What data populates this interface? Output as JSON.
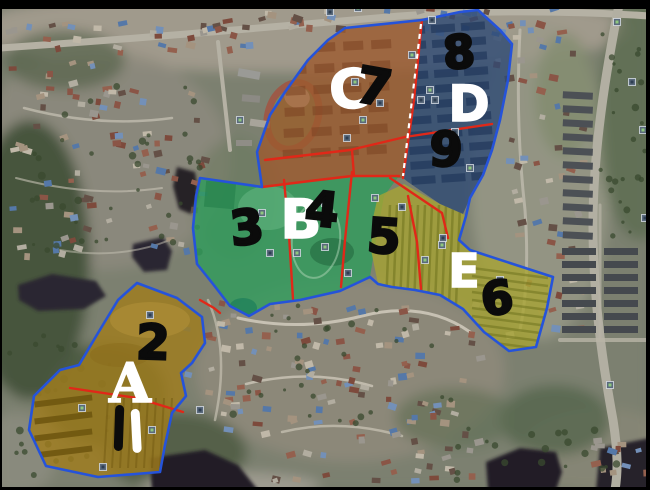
{
  "map": {
    "title": "Satellite map with zoned planning overlays",
    "view": "aerial-satellite",
    "colors": {
      "region_A_fill": "#a07d1d",
      "region_B_fill": "#2e9e5c",
      "region_C_fill": "#9c5a2e",
      "region_D_fill": "#2e4a74",
      "region_E_fill": "#a8a432",
      "outline_blue": "#2553da",
      "divider_red": "#e02818",
      "boundary_dash_white": "#ffffff",
      "label_white": "#ffffff",
      "label_black": "#0b0b0b",
      "frame_black": "#000000"
    },
    "zones": [
      {
        "zone": "A",
        "subzones": [
          "1",
          "2"
        ]
      },
      {
        "zone": "B",
        "subzones": [
          "3",
          "4"
        ]
      },
      {
        "zone": "C",
        "subzones": [
          "7"
        ]
      },
      {
        "zone": "D",
        "subzones": [
          "8",
          "9"
        ]
      },
      {
        "zone": "E",
        "subzones": [
          "5",
          "6"
        ]
      }
    ],
    "regions": [
      {
        "id": "C",
        "fill": "#9c5a2e",
        "opacity": 0.8,
        "points": "345,28 422,20 403,178 352,176 310,181 262,187 257,152 270,115 285,92 308,60 328,40"
      },
      {
        "id": "D",
        "fill": "#2e4a74",
        "opacity": 0.8,
        "points": "422,20 460,12 478,10 500,30 512,44 508,80 500,120 492,150 483,175 470,198 463,214 440,204 408,182 403,178"
      },
      {
        "id": "B",
        "fill": "#2e9e5c",
        "opacity": 0.78,
        "points": "200,178 262,187 310,181 352,176 399,176 384,196 376,240 370,277 340,291 300,300 270,304 249,316 230,306 213,284 197,264 193,228 196,196"
      },
      {
        "id": "E",
        "fill": "#a8a432",
        "opacity": 0.78,
        "points": "378,196 404,184 440,204 463,214 466,216 459,240 470,250 553,277 547,308 536,347 509,351 484,332 463,309 440,295 415,290 392,287 378,284 371,250 373,218"
      },
      {
        "id": "A",
        "fill": "#a07d1d",
        "opacity": 0.82,
        "points": "137,283 177,298 202,317 205,343 192,363 181,373 186,396 172,413 165,445 160,472 98,477 46,466 29,430 34,396 60,370 79,365 98,333 118,300"
      }
    ],
    "dividers_red": [
      {
        "points": "265,160 350,150 405,137 492,124"
      },
      {
        "points": "262,187 310,181 352,176 399,176"
      },
      {
        "points": "352,150 354,176"
      },
      {
        "points": "422,20 414,100 403,178"
      },
      {
        "points": "390,178 442,213 448,238"
      },
      {
        "points": "352,172 345,240 341,287"
      },
      {
        "points": "284,180 289,235 293,299"
      },
      {
        "points": "408,196 417,242 421,289"
      },
      {
        "points": "70,388 137,398 183,412"
      },
      {
        "points": "200,300 214,308 220,313"
      }
    ],
    "boundary_dashes_white": [
      {
        "points": "421,24 412,100 403,176"
      }
    ],
    "outlines_blue": [
      {
        "id": "main-complex",
        "points": "345,28 422,20 460,12 478,10 500,30 512,44 508,80 500,120 492,150 483,175 470,198 466,216 459,240 470,250 553,277 547,308 536,347 509,351 484,332 463,309 440,295 415,290 392,287 378,284 370,277 340,291 300,300 270,304 249,316 230,306 213,284 197,264 193,228 196,196 200,178 262,187 257,152 270,115 285,92 308,60 328,40"
      },
      {
        "id": "zone-A",
        "points": "137,283 177,298 202,317 205,343 192,363 181,373 186,396 172,413 165,445 160,472 98,477 46,466 29,430 34,396 60,370 79,365 98,333 118,300"
      }
    ],
    "labels": [
      {
        "id": "zone-letter-C",
        "text": "C",
        "kind": "letter",
        "color": "#ffffff",
        "x": 349,
        "y": 90,
        "size": 54,
        "rot": -4
      },
      {
        "id": "subzone-number-7",
        "text": "7",
        "kind": "number",
        "color": "#0b0b0b",
        "x": 374,
        "y": 87,
        "size": 50,
        "rot": 10
      },
      {
        "id": "subzone-number-8",
        "text": "8",
        "kind": "number",
        "color": "#0b0b0b",
        "x": 459,
        "y": 52,
        "size": 46,
        "rot": -4
      },
      {
        "id": "zone-letter-D",
        "text": "D",
        "kind": "letter",
        "color": "#ffffff",
        "x": 469,
        "y": 104,
        "size": 50,
        "rot": 0
      },
      {
        "id": "subzone-number-9",
        "text": "9",
        "kind": "number",
        "color": "#0b0b0b",
        "x": 446,
        "y": 150,
        "size": 48,
        "rot": 3
      },
      {
        "id": "subzone-number-3",
        "text": "3",
        "kind": "number",
        "color": "#0b0b0b",
        "x": 247,
        "y": 228,
        "size": 48,
        "rot": -6
      },
      {
        "id": "zone-letter-B",
        "text": "B",
        "kind": "letter",
        "color": "#ffffff",
        "x": 301,
        "y": 220,
        "size": 54,
        "rot": 0
      },
      {
        "id": "subzone-number-4",
        "text": "4",
        "kind": "number",
        "color": "#0b0b0b",
        "x": 322,
        "y": 210,
        "size": 48,
        "rot": 6
      },
      {
        "id": "subzone-number-5",
        "text": "5",
        "kind": "number",
        "color": "#0b0b0b",
        "x": 384,
        "y": 237,
        "size": 48,
        "rot": 4
      },
      {
        "id": "zone-letter-E",
        "text": "E",
        "kind": "letter",
        "color": "#ffffff",
        "x": 464,
        "y": 271,
        "size": 46,
        "rot": 0
      },
      {
        "id": "subzone-number-6",
        "text": "6",
        "kind": "number",
        "color": "#0b0b0b",
        "x": 497,
        "y": 298,
        "size": 46,
        "rot": -8
      },
      {
        "id": "subzone-number-2",
        "text": "2",
        "kind": "number",
        "color": "#0b0b0b",
        "x": 153,
        "y": 343,
        "size": 48,
        "rot": 2
      },
      {
        "id": "zone-letter-A",
        "text": "A",
        "kind": "letter",
        "serif": true,
        "color": "#ffffff",
        "x": 130,
        "y": 383,
        "size": 54,
        "rot": 0
      },
      {
        "id": "subzone-number-1",
        "text": "1",
        "kind": "number",
        "style": "bar",
        "color": "#0b0b0b",
        "x": 119,
        "y": 428,
        "size": 50,
        "rot": 2
      },
      {
        "id": "subzone-number-1-white-mark",
        "text": "1",
        "kind": "number",
        "style": "bar",
        "color": "#ffffff",
        "x": 136,
        "y": 431,
        "size": 48,
        "rot": -3
      }
    ],
    "photo_markers": [
      {
        "x": 330,
        "y": 12
      },
      {
        "x": 358,
        "y": 8
      },
      {
        "x": 432,
        "y": 20
      },
      {
        "x": 617,
        "y": 22
      },
      {
        "x": 632,
        "y": 82
      },
      {
        "x": 643,
        "y": 130
      },
      {
        "x": 645,
        "y": 218
      },
      {
        "x": 355,
        "y": 82
      },
      {
        "x": 380,
        "y": 103
      },
      {
        "x": 363,
        "y": 120
      },
      {
        "x": 347,
        "y": 138
      },
      {
        "x": 412,
        "y": 55
      },
      {
        "x": 435,
        "y": 100
      },
      {
        "x": 430,
        "y": 90
      },
      {
        "x": 455,
        "y": 132
      },
      {
        "x": 470,
        "y": 168
      },
      {
        "x": 421,
        "y": 100
      },
      {
        "x": 262,
        "y": 213
      },
      {
        "x": 270,
        "y": 253
      },
      {
        "x": 297,
        "y": 253
      },
      {
        "x": 325,
        "y": 203
      },
      {
        "x": 325,
        "y": 247
      },
      {
        "x": 348,
        "y": 273
      },
      {
        "x": 375,
        "y": 198
      },
      {
        "x": 402,
        "y": 207
      },
      {
        "x": 425,
        "y": 260
      },
      {
        "x": 443,
        "y": 238
      },
      {
        "x": 442,
        "y": 245
      },
      {
        "x": 500,
        "y": 280
      },
      {
        "x": 82,
        "y": 408
      },
      {
        "x": 103,
        "y": 467
      },
      {
        "x": 152,
        "y": 430
      },
      {
        "x": 200,
        "y": 410
      },
      {
        "x": 240,
        "y": 120
      },
      {
        "x": 150,
        "y": 315
      },
      {
        "x": 610,
        "y": 385
      }
    ]
  }
}
